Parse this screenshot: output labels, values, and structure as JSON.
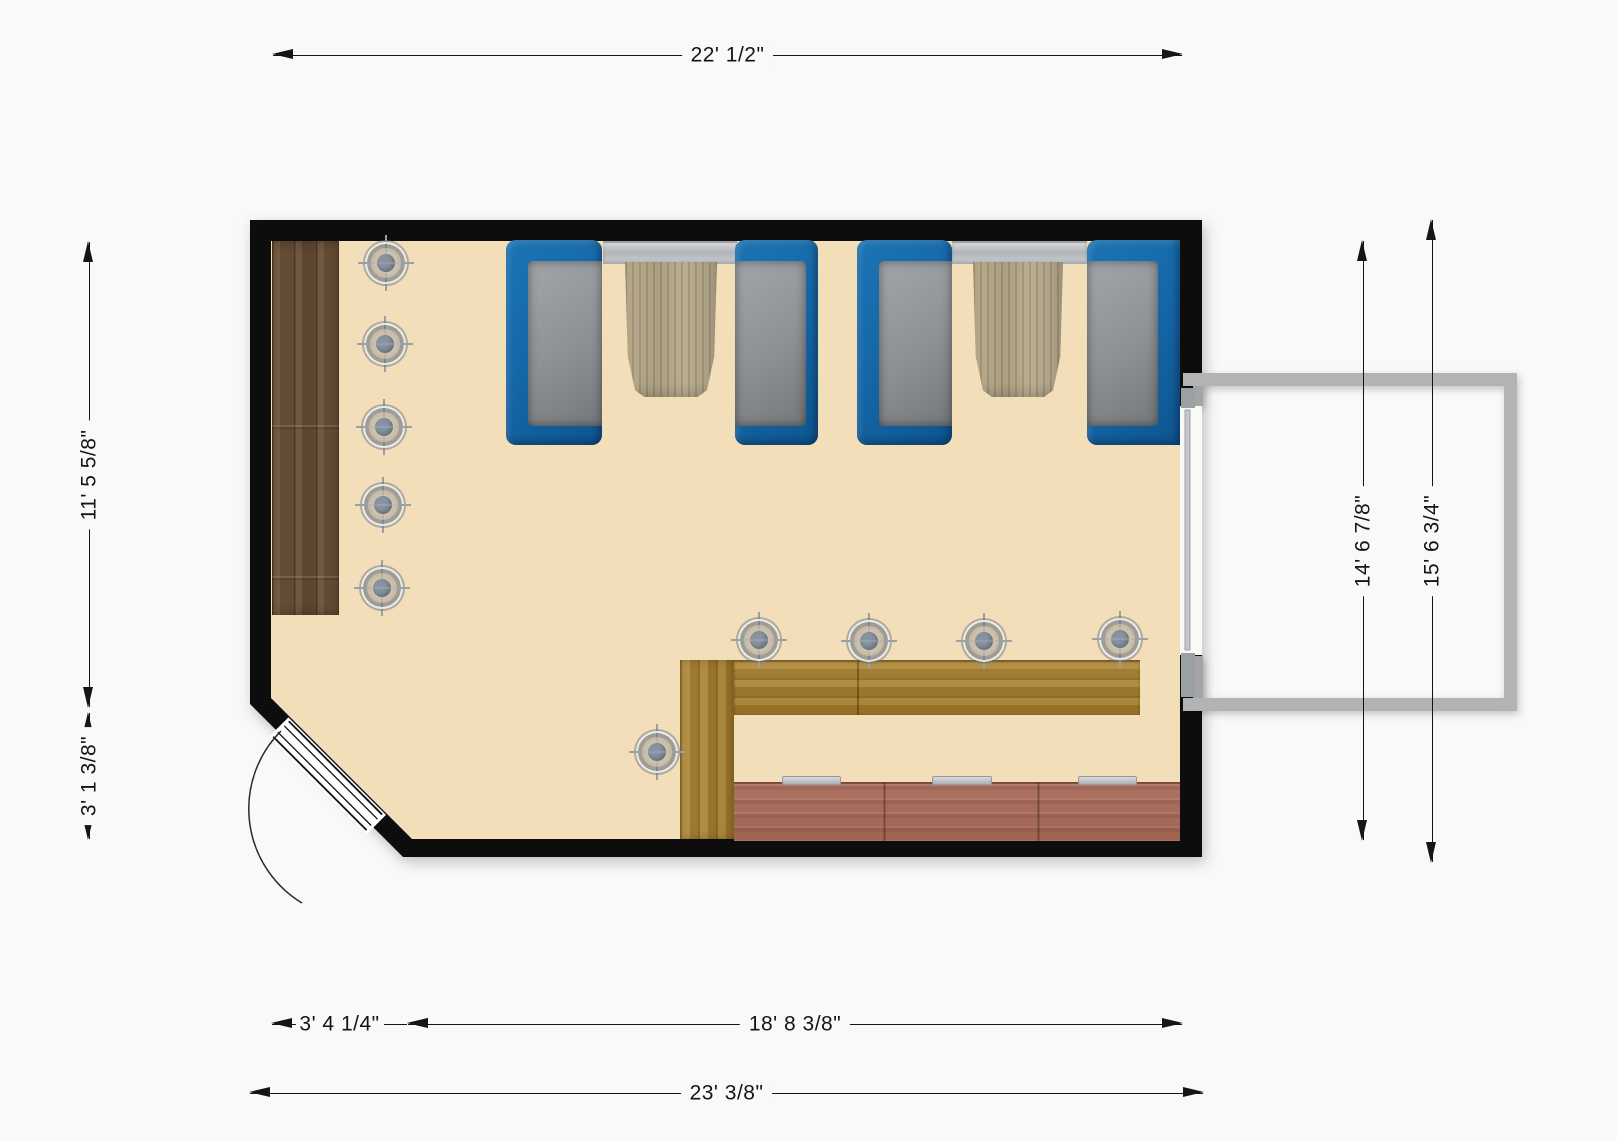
{
  "dimensions": {
    "top_width": "22' 1/2\"",
    "left_wall_upper": "11' 5 5/8\"",
    "left_wall_lower": "3' 1 3/8\"",
    "bottom_chamfer": "3' 4 1/4\"",
    "bottom_wall": "18' 8 3/8\"",
    "bottom_total": "23' 3/8\"",
    "right_inner_height": "14' 6 7/8\"",
    "right_outer_height": "15' 6 3/4\""
  },
  "icons": {
    "ceiling_light": "circle-crosshair-light"
  },
  "colors": {
    "bg": "#f9f9f7",
    "wall": "#0d0d0d",
    "floor": "#f3deba",
    "bench": "#1668a8",
    "bench-dark": "#0e5590",
    "cushion": "#8d9094",
    "table-wood": "#aea076",
    "window-gray": "#c0c3c7",
    "wood-dark": "#6b5138",
    "counter-wood": "#a8812f",
    "kitchen": "#a66a59",
    "porch": "#b3b3b3",
    "dim": "#151515"
  }
}
